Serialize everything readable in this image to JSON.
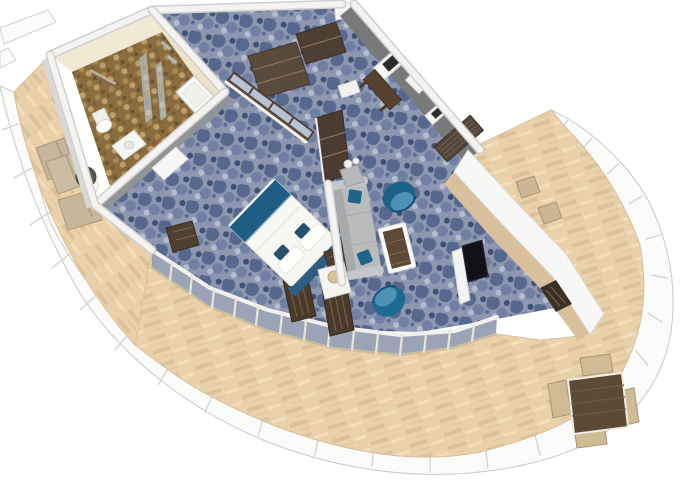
{
  "scene": {
    "title": "Aft-facing cruise ship suite — 3D cutaway floor plan",
    "description": "Isometric cutaway rendering of a suite with bedroom, living area, bathroom, entry hall and a wraparound teak balcony at the curved stern of the ship",
    "background": "#ffffff"
  },
  "rooms": {
    "bathroom": {
      "label": "Bathroom",
      "fixtures": [
        "walk-in shower",
        "glass shower partition",
        "toilet",
        "vanity sink",
        "bathtub",
        "towel bar",
        "chrome shelves"
      ]
    },
    "entry": {
      "label": "Entry hall",
      "features": [
        "entry door",
        "storage cubbies",
        "mirrored wardrobe"
      ],
      "mirror_panel_count": 4
    },
    "bedroom": {
      "label": "Bedroom",
      "furniture": [
        "king bed with blue runner and headboard",
        "dark nightstand",
        "white lamp table with lamp",
        "tall cabinet",
        "slatted luggage bench",
        "TV divider wall",
        "interior door"
      ]
    },
    "living": {
      "label": "Living area",
      "furniture": [
        "gray sofa with teal pillows",
        "teal tub armchair",
        "teal tub armchair",
        "walnut coffee table",
        "side table with carafes",
        "wall bench",
        "picture frame",
        "picture frame",
        "curtain panel",
        "TV console with flat-screen TV"
      ],
      "armchair_count": 2,
      "picture_frame_count": 2
    },
    "balcony": {
      "label": "Wraparound balcony",
      "furniture": [
        "sun lounger",
        "sun lounger",
        "sun lounger",
        "round drinks table",
        "deck chair",
        "deck chair",
        "dining table",
        "dining chairs x4",
        "slatted deck bench",
        "slatted deck bench"
      ],
      "lounger_count": 3,
      "dining_chair_count": 4,
      "deck_material": "teak planks",
      "railing": "white panelled railing with glass inserts"
    }
  },
  "colors": {
    "background": "#ffffff",
    "hull_white": "#fbfbfa",
    "rail_seam": "#d4d4d2",
    "deck_wood": "#e9d1ab",
    "deck_plank_dark": "#dcc29a",
    "deck_plank_light": "#f2debb",
    "carpet_base": "#8d98b0",
    "carpet_motif_dark": "#49597f",
    "carpet_motif_mid": "#707fa2",
    "carpet_motif_light": "#b9c1d3",
    "wall_top": "#f4f3f1",
    "wall_gray": "#77797b",
    "wall_light_gray": "#9aa0a2",
    "bath_wall_cream": "#f2e9d4",
    "bath_floor_brown": "#8a6c3e",
    "fixture_white": "#f7f7f4",
    "glass_tint": "#7f8ba3",
    "door_frame_tan": "#cbbd9b",
    "wood_dark": "#4e3f33",
    "wood_walnut": "#5c4936",
    "tan_furniture": "#cbb795",
    "teal_chair": "#1b618a",
    "teal_chair_light": "#4d92b4",
    "bed_blue": "#1e5d84",
    "sofa_gray": "#b9bbbd",
    "mirror_blue": "#b7c4d5",
    "console_wood": "#d9c09c",
    "tv_black": "#121216"
  }
}
